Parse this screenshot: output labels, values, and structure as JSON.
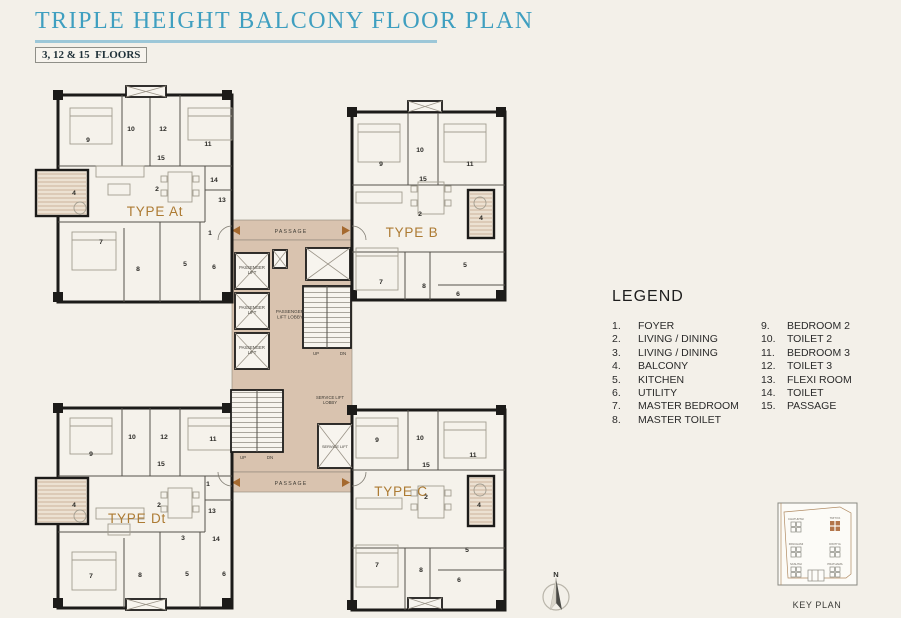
{
  "header": {
    "title": "TRIPLE HEIGHT BALCONY FLOOR PLAN",
    "floors": "3, 12 & 15  FLOORS"
  },
  "legend": {
    "title": "LEGEND",
    "items": [
      {
        "num": "1.",
        "label": "FOYER"
      },
      {
        "num": "2.",
        "label": "LIVING / DINING"
      },
      {
        "num": "3.",
        "label": "LIVING / DINING"
      },
      {
        "num": "4.",
        "label": "BALCONY"
      },
      {
        "num": "5.",
        "label": "KITCHEN"
      },
      {
        "num": "6.",
        "label": "UTILITY"
      },
      {
        "num": "7.",
        "label": "MASTER BEDROOM"
      },
      {
        "num": "8.",
        "label": "MASTER TOILET"
      },
      {
        "num": "9.",
        "label": "BEDROOM 2"
      },
      {
        "num": "10.",
        "label": "TOILET 2"
      },
      {
        "num": "11.",
        "label": "BEDROOM 3"
      },
      {
        "num": "12.",
        "label": "TOILET 3"
      },
      {
        "num": "13.",
        "label": "FLEXI ROOM"
      },
      {
        "num": "14.",
        "label": "TOILET"
      },
      {
        "num": "15.",
        "label": "PASSAGE"
      }
    ]
  },
  "plan": {
    "unit_labels": [
      {
        "text": "TYPE At",
        "x": 155,
        "y": 216
      },
      {
        "text": "TYPE B",
        "x": 412,
        "y": 237
      },
      {
        "text": "TYPE Dt",
        "x": 137,
        "y": 523
      },
      {
        "text": "TYPE C",
        "x": 401,
        "y": 496
      }
    ],
    "core_labels": [
      {
        "text": "PASSAGE",
        "x": 291,
        "y": 233,
        "size": 5.2,
        "ls": 1.2
      },
      {
        "text": "PASSAGE",
        "x": 291,
        "y": 485,
        "size": 5.2,
        "ls": 1.2
      },
      {
        "text": "PASSENGER\nLIFT",
        "x": 252,
        "y": 269,
        "size": 4.2
      },
      {
        "text": "PASSENGER\nLIFT",
        "x": 252,
        "y": 309,
        "size": 4.2
      },
      {
        "text": "PASSENGER\nLIFT",
        "x": 252,
        "y": 349,
        "size": 4.2
      },
      {
        "text": "PASSENGER\nLIFT LOBBY",
        "x": 290,
        "y": 313,
        "size": 4.6
      },
      {
        "text": "SERVICE LIFT\nLOBBY",
        "x": 330,
        "y": 399,
        "size": 4.2
      },
      {
        "text": "SERVICE LIFT",
        "x": 335,
        "y": 448,
        "size": 3.9
      },
      {
        "text": "UP",
        "x": 316,
        "y": 355,
        "size": 4.4
      },
      {
        "text": "DN",
        "x": 343,
        "y": 355,
        "size": 4.4
      },
      {
        "text": "UP",
        "x": 243,
        "y": 459,
        "size": 4.4
      },
      {
        "text": "DN",
        "x": 270,
        "y": 459,
        "size": 4.4
      }
    ],
    "rooms": [
      {
        "unit": "TYPE At",
        "n": "9",
        "x": 88,
        "y": 142
      },
      {
        "unit": "TYPE At",
        "n": "10",
        "x": 131,
        "y": 131
      },
      {
        "unit": "TYPE At",
        "n": "12",
        "x": 163,
        "y": 131
      },
      {
        "unit": "TYPE At",
        "n": "11",
        "x": 208,
        "y": 146
      },
      {
        "unit": "TYPE At",
        "n": "15",
        "x": 161,
        "y": 160
      },
      {
        "unit": "TYPE At",
        "n": "4",
        "x": 74,
        "y": 195
      },
      {
        "unit": "TYPE At",
        "n": "2",
        "x": 157,
        "y": 191
      },
      {
        "unit": "TYPE At",
        "n": "14",
        "x": 214,
        "y": 182
      },
      {
        "unit": "TYPE At",
        "n": "13",
        "x": 222,
        "y": 202
      },
      {
        "unit": "TYPE At",
        "n": "1",
        "x": 210,
        "y": 235
      },
      {
        "unit": "TYPE At",
        "n": "7",
        "x": 101,
        "y": 244
      },
      {
        "unit": "TYPE At",
        "n": "8",
        "x": 138,
        "y": 271
      },
      {
        "unit": "TYPE At",
        "n": "5",
        "x": 185,
        "y": 266
      },
      {
        "unit": "TYPE At",
        "n": "6",
        "x": 214,
        "y": 269
      },
      {
        "unit": "TYPE B",
        "n": "9",
        "x": 381,
        "y": 166
      },
      {
        "unit": "TYPE B",
        "n": "10",
        "x": 420,
        "y": 152
      },
      {
        "unit": "TYPE B",
        "n": "11",
        "x": 470,
        "y": 166
      },
      {
        "unit": "TYPE B",
        "n": "15",
        "x": 423,
        "y": 181
      },
      {
        "unit": "TYPE B",
        "n": "2",
        "x": 420,
        "y": 216
      },
      {
        "unit": "TYPE B",
        "n": "4",
        "x": 481,
        "y": 220
      },
      {
        "unit": "TYPE B",
        "n": "7",
        "x": 381,
        "y": 284
      },
      {
        "unit": "TYPE B",
        "n": "8",
        "x": 424,
        "y": 288
      },
      {
        "unit": "TYPE B",
        "n": "5",
        "x": 465,
        "y": 267
      },
      {
        "unit": "TYPE B",
        "n": "6",
        "x": 458,
        "y": 296
      },
      {
        "unit": "TYPE Dt",
        "n": "9",
        "x": 91,
        "y": 456
      },
      {
        "unit": "TYPE Dt",
        "n": "10",
        "x": 132,
        "y": 439
      },
      {
        "unit": "TYPE Dt",
        "n": "12",
        "x": 164,
        "y": 439
      },
      {
        "unit": "TYPE Dt",
        "n": "11",
        "x": 213,
        "y": 441
      },
      {
        "unit": "TYPE Dt",
        "n": "15",
        "x": 161,
        "y": 466
      },
      {
        "unit": "TYPE Dt",
        "n": "4",
        "x": 74,
        "y": 507
      },
      {
        "unit": "TYPE Dt",
        "n": "2",
        "x": 159,
        "y": 507
      },
      {
        "unit": "TYPE Dt",
        "n": "1",
        "x": 208,
        "y": 486
      },
      {
        "unit": "TYPE Dt",
        "n": "13",
        "x": 212,
        "y": 513
      },
      {
        "unit": "TYPE Dt",
        "n": "14",
        "x": 216,
        "y": 541
      },
      {
        "unit": "TYPE Dt",
        "n": "3",
        "x": 183,
        "y": 540
      },
      {
        "unit": "TYPE Dt",
        "n": "7",
        "x": 91,
        "y": 578
      },
      {
        "unit": "TYPE Dt",
        "n": "8",
        "x": 140,
        "y": 577
      },
      {
        "unit": "TYPE Dt",
        "n": "5",
        "x": 187,
        "y": 576
      },
      {
        "unit": "TYPE Dt",
        "n": "6",
        "x": 224,
        "y": 576
      },
      {
        "unit": "TYPE C",
        "n": "9",
        "x": 377,
        "y": 442
      },
      {
        "unit": "TYPE C",
        "n": "10",
        "x": 420,
        "y": 440
      },
      {
        "unit": "TYPE C",
        "n": "11",
        "x": 473,
        "y": 457
      },
      {
        "unit": "TYPE C",
        "n": "15",
        "x": 426,
        "y": 467
      },
      {
        "unit": "TYPE C",
        "n": "2",
        "x": 426,
        "y": 499
      },
      {
        "unit": "TYPE C",
        "n": "4",
        "x": 479,
        "y": 507
      },
      {
        "unit": "TYPE C",
        "n": "7",
        "x": 377,
        "y": 567
      },
      {
        "unit": "TYPE C",
        "n": "8",
        "x": 421,
        "y": 572
      },
      {
        "unit": "TYPE C",
        "n": "5",
        "x": 467,
        "y": 552
      },
      {
        "unit": "TYPE C",
        "n": "6",
        "x": 459,
        "y": 582
      }
    ],
    "compass": {
      "label": "N",
      "x": 556,
      "y": 577
    },
    "key_plan": {
      "caption": "KEY PLAN",
      "caption_x": 817,
      "caption_y": 608,
      "towers": [
        {
          "name": "CHATURTHI",
          "x": 796,
          "y": 527,
          "highlight": false
        },
        {
          "name": "TRITIYA",
          "x": 835,
          "y": 526,
          "highlight": true
        },
        {
          "name": "PANCHAMI",
          "x": 796,
          "y": 552,
          "highlight": false
        },
        {
          "name": "DWITIYA",
          "x": 835,
          "y": 552,
          "highlight": false
        },
        {
          "name": "SASHTHI",
          "x": 796,
          "y": 572,
          "highlight": false
        },
        {
          "name": "PRATHAMA",
          "x": 835,
          "y": 572,
          "highlight": false
        }
      ]
    }
  },
  "colors": {
    "bg": "#f3f0e9",
    "title_teal": "#3f9fc0",
    "title_rule": "#9cc7d8",
    "wall": "#1c1b19",
    "core_tan": "#d9c3af",
    "arrow_brown": "#a5692f",
    "type_label": "#ad7b33",
    "keyplan_highlight": "#b3764b"
  }
}
